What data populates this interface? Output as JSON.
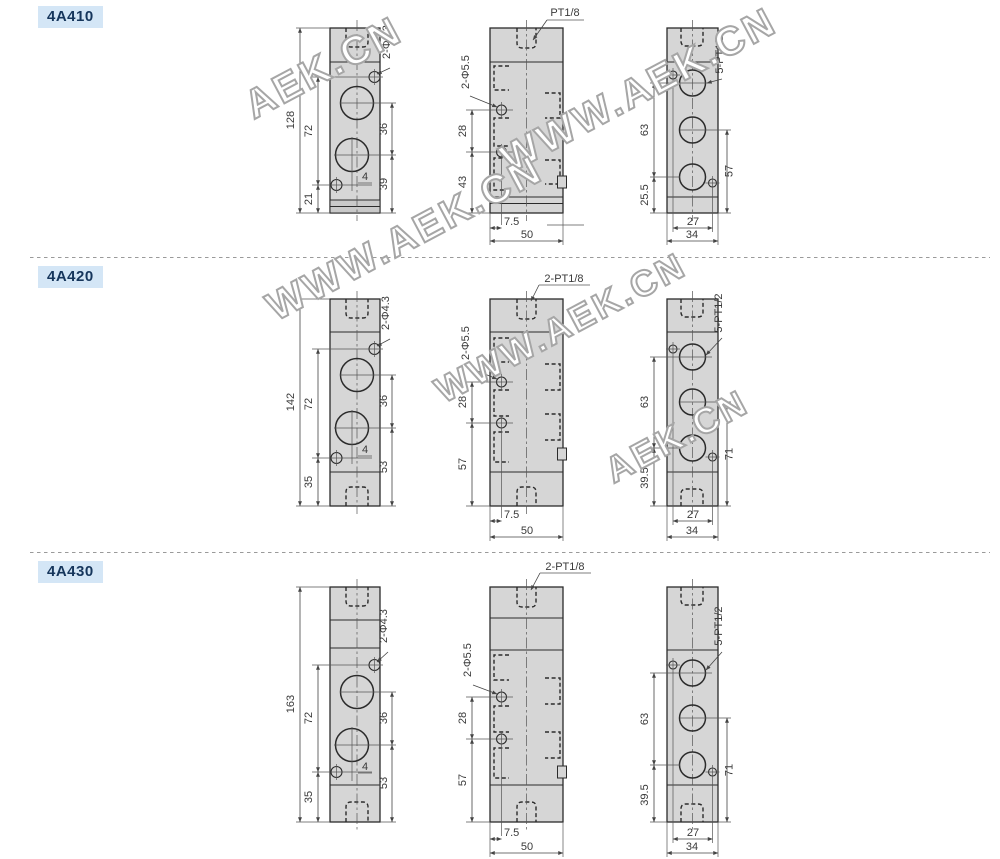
{
  "sections": [
    {
      "label": "4A410",
      "front": {
        "overall_height": "128",
        "screw_spacing": "72",
        "screw_to_bottom": "21",
        "port_spacing": "36",
        "port_to_bottom": "39",
        "port_offset": "4",
        "mount_holes": "2-Φ4.3"
      },
      "side": {
        "top_port": "PT1/8",
        "pilot_holes": "2-Φ5.5",
        "hole_spacing": "28",
        "hole_to_bottom": "43",
        "hole_from_edge": "7.5",
        "body_width": "50"
      },
      "back": {
        "ports": "5-PT1/2",
        "port_spacing": "63",
        "port_to_bottom": "25.5",
        "mid_port_to_bottom": "57",
        "screw_spacing": "27",
        "body_width": "34"
      }
    },
    {
      "label": "4A420",
      "front": {
        "overall_height": "142",
        "screw_spacing": "72",
        "screw_to_bottom": "35",
        "port_spacing": "36",
        "port_to_bottom": "53",
        "port_offset": "4",
        "mount_holes": "2-Φ4.3"
      },
      "side": {
        "top_port": "2-PT1/8",
        "pilot_holes": "2-Φ5.5",
        "hole_spacing": "28",
        "hole_to_bottom": "57",
        "hole_from_edge": "7.5",
        "body_width": "50"
      },
      "back": {
        "ports": "5-PT1/2",
        "port_spacing": "63",
        "port_to_bottom": "39.5",
        "mid_port_to_bottom": "71",
        "screw_spacing": "27",
        "body_width": "34"
      }
    },
    {
      "label": "4A430",
      "front": {
        "overall_height": "163",
        "screw_spacing": "72",
        "screw_to_bottom": "35",
        "port_spacing": "36",
        "port_to_bottom": "53",
        "port_offset": "4",
        "mount_holes": "2-Φ4.3"
      },
      "side": {
        "top_port": "2-PT1/8",
        "pilot_holes": "2-Φ5.5",
        "hole_spacing": "28",
        "hole_to_bottom": "57",
        "hole_from_edge": "7.5",
        "body_width": "50"
      },
      "back": {
        "ports": "5-PT1/2",
        "port_spacing": "63",
        "port_to_bottom": "39.5",
        "mid_port_to_bottom": "71",
        "screw_spacing": "27",
        "body_width": "34"
      }
    }
  ],
  "watermarks": [
    {
      "text": "AEK.CN"
    },
    {
      "text": "WWW.AEK.CN"
    },
    {
      "text": "WWW.AEK.CN"
    },
    {
      "text": "WWW.AEK.CN"
    },
    {
      "text": "AEK.CN"
    }
  ],
  "colors": {
    "body_fill": "#d6d6d6",
    "line": "#2b2b2b",
    "badge_bg": "#d4e6f6",
    "badge_text": "#16365c",
    "watermark": "#a6a6a6",
    "separator": "#9a9a9a"
  }
}
